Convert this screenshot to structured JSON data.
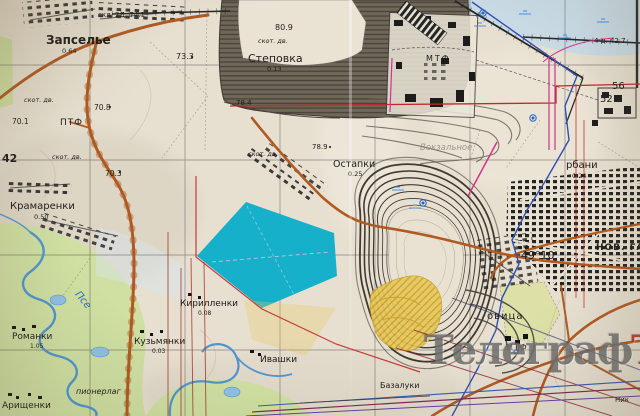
{
  "watermark": {
    "text_main": "Телеграф",
    "text_suffix": "Ъ",
    "color_main": "#6e6e6e",
    "color_suffix": "#b5241a"
  },
  "palette": {
    "paper": "#e7e0d1",
    "road_orange": "#b05a22",
    "planned_reservoir_cyan": "#17b0ca",
    "floodplain_green": "#cfe0a2",
    "river_blue": "#4f94cf",
    "quarry_contour_dark": "#413a30",
    "waste_dump_gray": "#6f6859",
    "mining_area_yellow": "#e7c85a",
    "overlay_red": "#c22828",
    "overlay_blue": "#3050b2",
    "overlay_magenta": "#d1348c",
    "marsh_blue": "#c6dcec"
  },
  "labels": [
    {
      "n": "label-zapselye",
      "t": "Запселье",
      "x": 46,
      "y": 34,
      "s": 12,
      "b": 1
    },
    {
      "n": "label-zapselye-num",
      "t": "0.64",
      "x": 62,
      "y": 48,
      "s": 6.5
    },
    {
      "n": "label-skl",
      "t": "скл. 2Д. 74.1",
      "x": 98,
      "y": 12,
      "s": 7
    },
    {
      "n": "label-elev-73-3",
      "t": "73.3",
      "x": 176,
      "y": 53,
      "s": 8
    },
    {
      "n": "label-skotdv-1",
      "t": "скот. дв.",
      "x": 24,
      "y": 97,
      "s": 6.5,
      "i": 1
    },
    {
      "n": "label-elev-70-8",
      "t": "70.8",
      "x": 94,
      "y": 104,
      "s": 7.5
    },
    {
      "n": "label-elev-70-1",
      "t": "70.1",
      "x": 12,
      "y": 118,
      "s": 7.5
    },
    {
      "n": "label-ptf",
      "t": "ПТФ",
      "x": 60,
      "y": 119,
      "s": 9,
      "ls": 1
    },
    {
      "n": "label-grid-42",
      "t": "42",
      "x": 2,
      "y": 153,
      "s": 11,
      "b": 1
    },
    {
      "n": "label-skotdv-2",
      "t": "скот. дв.",
      "x": 52,
      "y": 154,
      "s": 6.5,
      "i": 1
    },
    {
      "n": "label-elev-70-3",
      "t": "70.3",
      "x": 105,
      "y": 170,
      "s": 7.5
    },
    {
      "n": "label-kramarenki",
      "t": "Крамаренки",
      "x": 10,
      "y": 202,
      "s": 10
    },
    {
      "n": "label-kramarenki-num",
      "t": "0.50",
      "x": 34,
      "y": 214,
      "s": 6.5
    },
    {
      "n": "label-skotdv-3",
      "t": "скот. дв.",
      "x": 248,
      "y": 151,
      "s": 6.5,
      "i": 1
    },
    {
      "n": "label-stepovka",
      "t": "Степовка",
      "x": 248,
      "y": 53,
      "s": 11
    },
    {
      "n": "label-stepovka-num",
      "t": "0.13",
      "x": 267,
      "y": 66,
      "s": 6.5
    },
    {
      "n": "label-elev-80-9",
      "t": "80.9",
      "x": 275,
      "y": 24,
      "s": 8
    },
    {
      "n": "label-skotdv-4",
      "t": "скот. дв.",
      "x": 258,
      "y": 38,
      "s": 6.5,
      "i": 1
    },
    {
      "n": "label-ostapki",
      "t": "Остапки",
      "x": 333,
      "y": 160,
      "s": 9.5
    },
    {
      "n": "label-ostapki-num",
      "t": "0.25",
      "x": 348,
      "y": 171,
      "s": 6.5
    },
    {
      "n": "label-elev-78-9",
      "t": "78.9",
      "x": 312,
      "y": 144,
      "s": 7
    },
    {
      "n": "label-elev-78-4",
      "t": "78.4",
      "x": 236,
      "y": 100,
      "s": 7
    },
    {
      "n": "label-mtf-plant",
      "t": "МТФ",
      "x": 426,
      "y": 55,
      "s": 8,
      "ls": 2
    },
    {
      "n": "label-vokzalnoye",
      "t": "Вокзальное",
      "x": 420,
      "y": 144,
      "s": 8.5,
      "c": "gray",
      "i": 1,
      "o": 0.8
    },
    {
      "n": "label-elev-42-7",
      "t": "4 д. 42.7",
      "x": 594,
      "y": 38,
      "s": 7
    },
    {
      "n": "label-grid-56",
      "t": "56",
      "x": 612,
      "y": 82,
      "s": 10
    },
    {
      "n": "label-grid-52",
      "t": "52",
      "x": 600,
      "y": 95,
      "s": 10
    },
    {
      "n": "label-gorbani",
      "t": "рбани",
      "x": 566,
      "y": 161,
      "s": 10
    },
    {
      "n": "label-gorbani-num",
      "t": "0.24",
      "x": 572,
      "y": 173,
      "s": 6.5
    },
    {
      "n": "label-graticule-49-10",
      "t": "49°10'",
      "x": 521,
      "y": 250,
      "s": 11
    },
    {
      "n": "label-nov-ga",
      "t": "НОВ. ГА",
      "x": 596,
      "y": 244,
      "s": 9,
      "b": 1,
      "ls": 1
    },
    {
      "n": "label-ovitsa",
      "t": "овица",
      "x": 487,
      "y": 312,
      "s": 10,
      "ls": 1
    },
    {
      "n": "label-mtf-south",
      "t": "МТФ",
      "x": 506,
      "y": 344,
      "s": 8,
      "ls": 1
    },
    {
      "n": "label-bazaluki",
      "t": "Базалуки",
      "x": 380,
      "y": 382,
      "s": 8
    },
    {
      "n": "label-nik",
      "t": "Ник",
      "x": 615,
      "y": 397,
      "s": 7
    },
    {
      "n": "label-kirillenki",
      "t": "Кирилленки",
      "x": 180,
      "y": 300,
      "s": 9
    },
    {
      "n": "label-kirillenki-num",
      "t": "0.08",
      "x": 198,
      "y": 311,
      "s": 6
    },
    {
      "n": "label-kuzmyanki",
      "t": "Кузьмянки",
      "x": 134,
      "y": 338,
      "s": 9
    },
    {
      "n": "label-kuzmyanki-num",
      "t": "0.03",
      "x": 152,
      "y": 349,
      "s": 6
    },
    {
      "n": "label-ivashki",
      "t": "Ивашки",
      "x": 260,
      "y": 356,
      "s": 9
    },
    {
      "n": "label-romanki",
      "t": "Романки",
      "x": 12,
      "y": 333,
      "s": 9
    },
    {
      "n": "label-romanki-num",
      "t": "1.05",
      "x": 30,
      "y": 344,
      "s": 6
    },
    {
      "n": "label-arishchenki",
      "t": "Арищенки",
      "x": 2,
      "y": 402,
      "s": 9
    },
    {
      "n": "label-pionerlag",
      "t": "пионерлаг",
      "x": 76,
      "y": 388,
      "s": 8,
      "i": 1
    },
    {
      "n": "label-river-psel",
      "t": "Псе",
      "x": 80,
      "y": 290,
      "s": 10,
      "c": "blue",
      "i": 1,
      "r": 50
    }
  ]
}
